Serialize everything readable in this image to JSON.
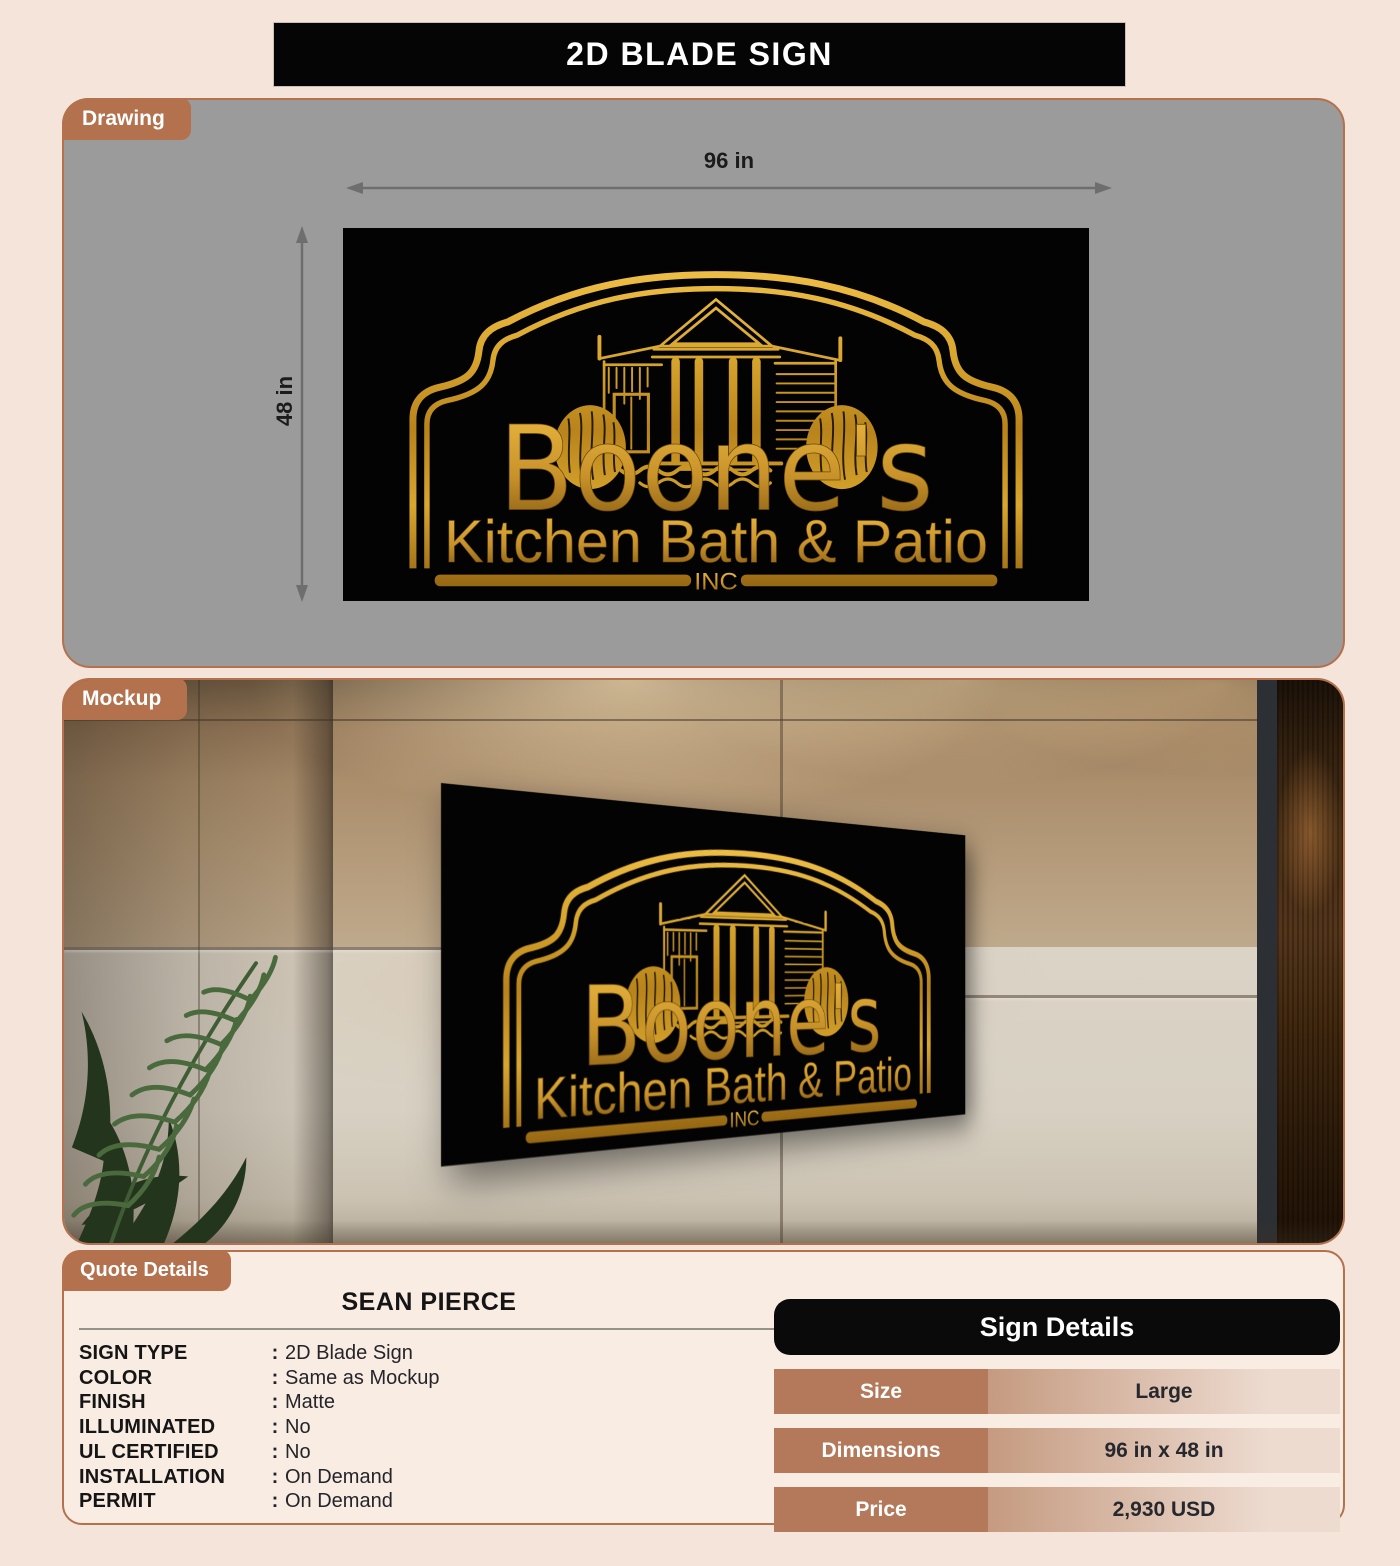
{
  "title": "2D BLADE SIGN",
  "tabs": {
    "drawing": "Drawing",
    "mockup": "Mockup",
    "quote": "Quote Details"
  },
  "drawing": {
    "width_label": "96 in",
    "height_label": "48 in"
  },
  "sign": {
    "name": "Boone's",
    "tagline": "Kitchen Bath & Patio",
    "suffix": "INC"
  },
  "quote": {
    "customer": "SEAN PIERCE",
    "separator": ":",
    "fields": [
      {
        "label": "SIGN TYPE",
        "value": "2D Blade Sign"
      },
      {
        "label": "COLOR",
        "value": "Same as Mockup"
      },
      {
        "label": "FINISH",
        "value": "Matte"
      },
      {
        "label": "ILLUMINATED",
        "value": "No"
      },
      {
        "label": "UL CERTIFIED",
        "value": "No"
      },
      {
        "label": "INSTALLATION",
        "value": "On Demand"
      },
      {
        "label": "PERMIT",
        "value": "On Demand"
      }
    ]
  },
  "sign_details": {
    "title": "Sign Details",
    "rows": [
      {
        "label": "Size",
        "value": "Large"
      },
      {
        "label": "Dimensions",
        "value": "96 in x 48 in"
      },
      {
        "label": "Price",
        "value": "2,930 USD"
      }
    ]
  },
  "colors": {
    "accent": "#b3714e",
    "gold": "#c8922a",
    "panel_gray": "#9b9b9b",
    "page_bg": "#f5e4da",
    "table_label": "#b3795a",
    "header_black": "#0a0a0a"
  }
}
